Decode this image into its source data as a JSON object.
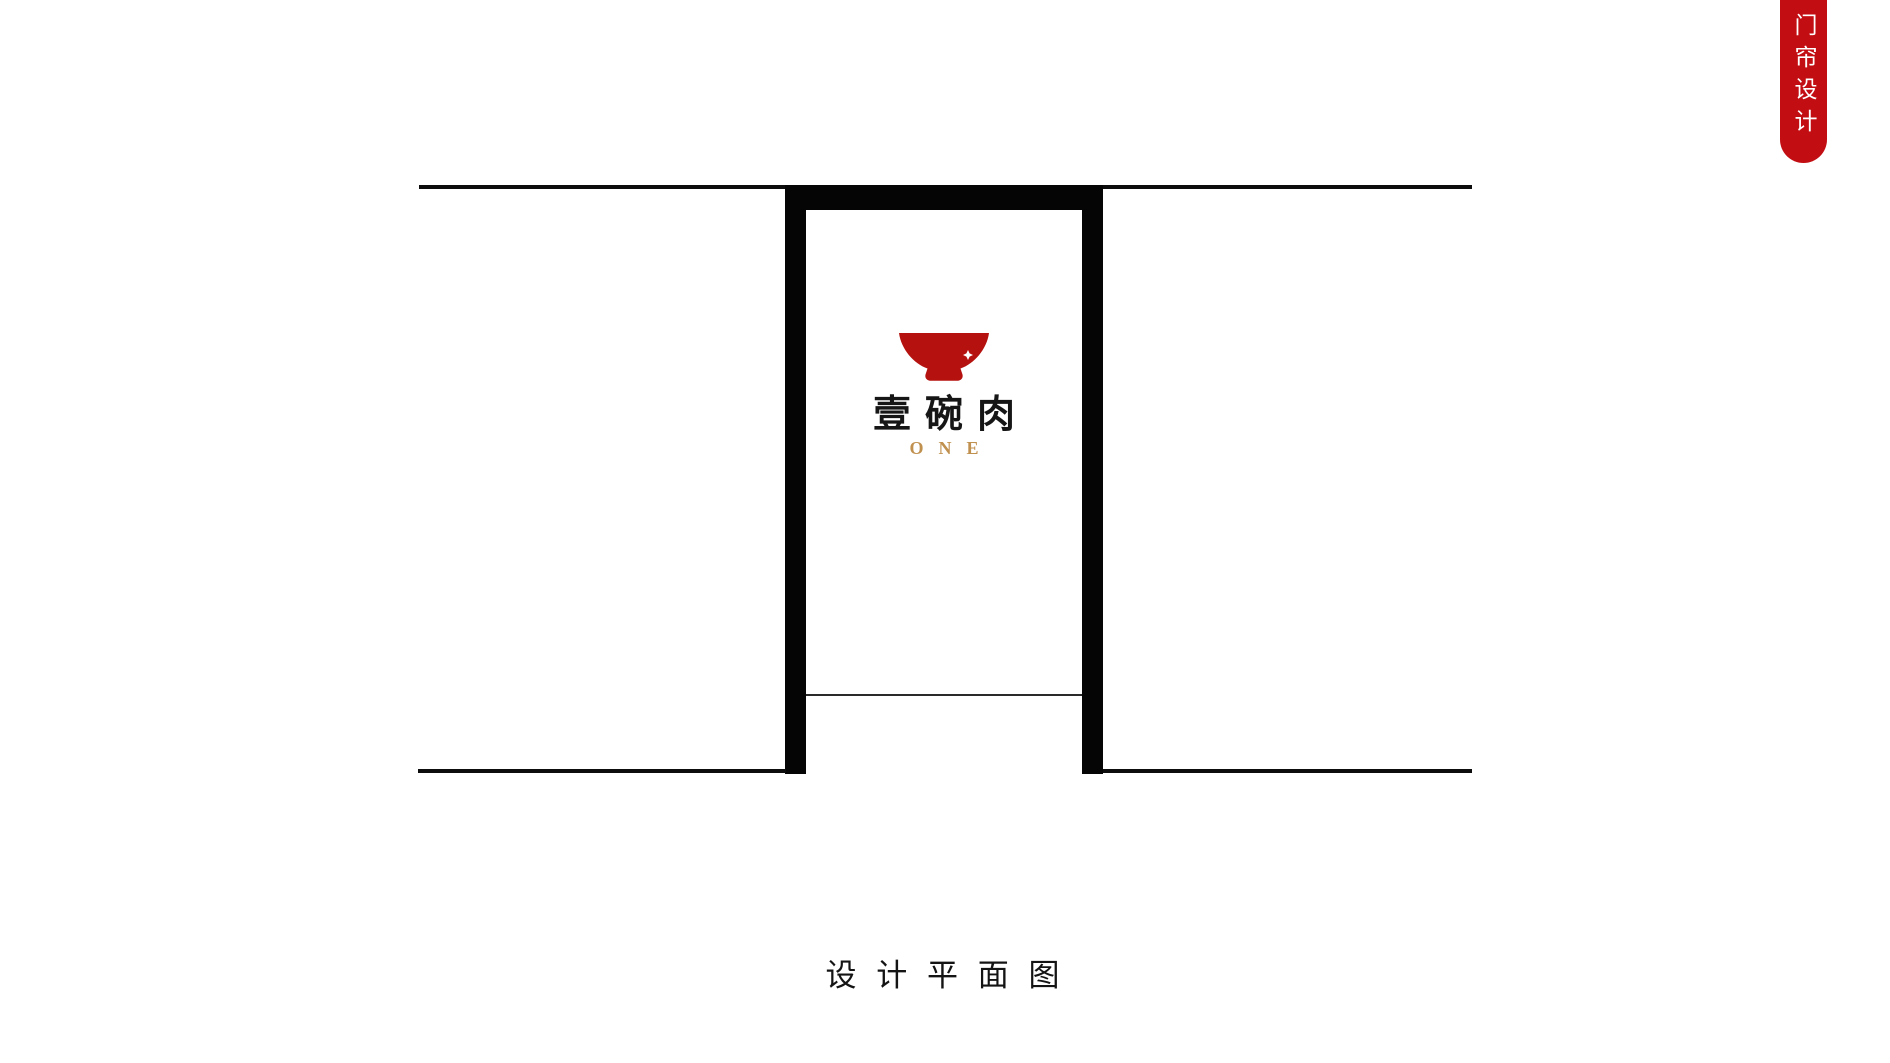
{
  "page": {
    "background_color": "#ffffff"
  },
  "ribbon": {
    "label": "门帘设计",
    "background_color": "#c20e13",
    "text_color": "#ffffff"
  },
  "floor_plan": {
    "wall_line_color": "#0d0d0d",
    "door_frame_color": "#050505"
  },
  "curtain": {
    "logo": {
      "bowl_icon": "red-bowl-icon",
      "bowl_color": "#b5120f",
      "sparkle_color": "#ffffff",
      "title": "壹碗肉",
      "title_color": "#161616",
      "subtitle": "ONE",
      "subtitle_color": "#c0904e"
    }
  },
  "caption": {
    "label": "设 计 平 面 图"
  }
}
